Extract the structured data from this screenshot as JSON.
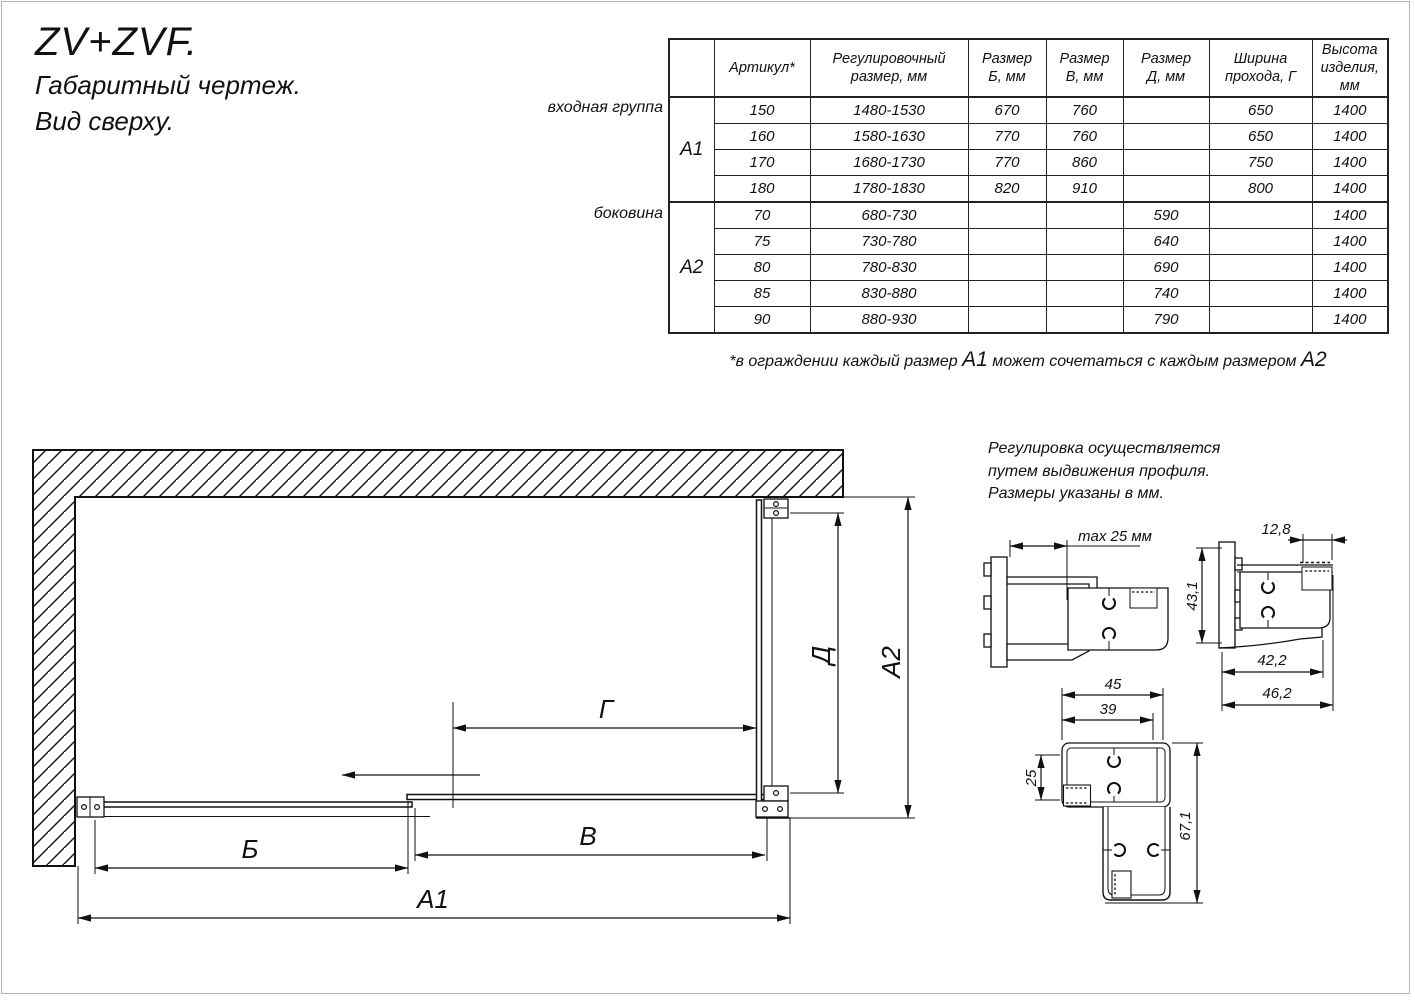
{
  "title": {
    "product": "ZV+ZVF.",
    "subtitle1": "Габаритный чертеж.",
    "subtitle2": "Вид сверху."
  },
  "table": {
    "headers": {
      "article": "Артикул*",
      "adjust": "Регулировочный\nразмер, мм",
      "size_b": "Размер\nБ, мм",
      "size_v": "Размер\nВ, мм",
      "size_d": "Размер\nД, мм",
      "pass": "Ширина\nпрохода, Г",
      "height": "Высота\nизделия,\nмм"
    },
    "groups": {
      "a1_side": "входная группа",
      "a1_code": "А1",
      "a2_side": "боковина",
      "a2_code": "А2"
    },
    "a1_rows": [
      [
        "150",
        "1480-1530",
        "670",
        "760",
        "",
        "650",
        "1400"
      ],
      [
        "160",
        "1580-1630",
        "770",
        "760",
        "",
        "650",
        "1400"
      ],
      [
        "170",
        "1680-1730",
        "770",
        "860",
        "",
        "750",
        "1400"
      ],
      [
        "180",
        "1780-1830",
        "820",
        "910",
        "",
        "800",
        "1400"
      ]
    ],
    "a2_rows": [
      [
        "70",
        "680-730",
        "",
        "",
        "590",
        "",
        "1400"
      ],
      [
        "75",
        "730-780",
        "",
        "",
        "640",
        "",
        "1400"
      ],
      [
        "80",
        "780-830",
        "",
        "",
        "690",
        "",
        "1400"
      ],
      [
        "85",
        "830-880",
        "",
        "",
        "740",
        "",
        "1400"
      ],
      [
        "90",
        "880-930",
        "",
        "",
        "790",
        "",
        "1400"
      ]
    ]
  },
  "footnote": {
    "part1": "*в ограждении каждый размер ",
    "a1": "А1",
    "part2": " может сочетаться с каждым размером ",
    "a2": "А2"
  },
  "note": {
    "line1": "Регулировка осуществляется",
    "line2": "путем выдвижения профиля.",
    "line3": "Размеры указаны в мм."
  },
  "dims": {
    "b": "Б",
    "v": "В",
    "g": "Г",
    "d": "Д",
    "a1": "А1",
    "a2": "А2",
    "max25": "max 25 мм",
    "w12_8": "12,8",
    "h43_1": "43,1",
    "w42_2": "42,2",
    "w46_2": "46,2",
    "w45": "45",
    "w39": "39",
    "h25": "25",
    "h67_1": "67,1"
  }
}
